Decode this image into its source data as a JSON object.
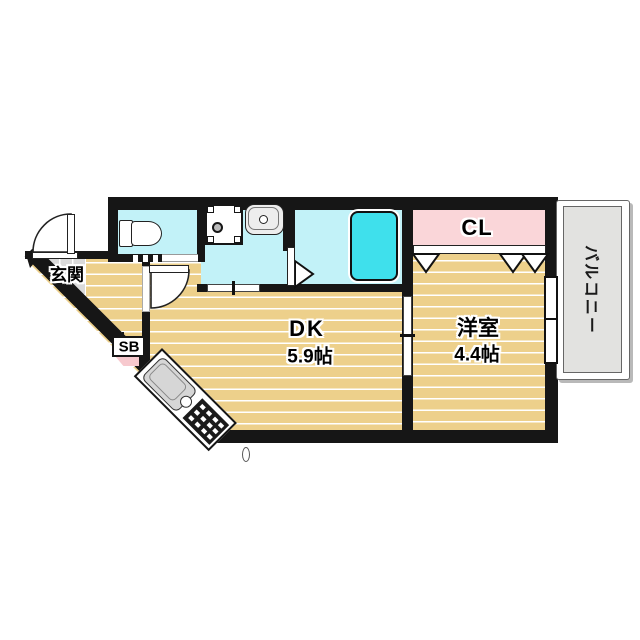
{
  "plan": {
    "rooms": {
      "entrance": {
        "label": "玄関"
      },
      "dining_kitchen": {
        "label": "DK",
        "size": "5.9帖"
      },
      "western_room": {
        "label": "洋室",
        "size": "4.4帖"
      },
      "closet": {
        "label": "CL"
      },
      "balcony": {
        "label": "バルコニー"
      },
      "shoe_box": {
        "label": "SB"
      }
    },
    "fixtures": [
      "toilet",
      "washing-machine-pan",
      "washbasin",
      "bathtub",
      "kitchen-sink",
      "gas-stove",
      "entry-door",
      "hinged-door",
      "sliding-door",
      "folding-door",
      "sliding-window",
      "closet-folding-doors"
    ],
    "colors": {
      "wall": "#161616",
      "wet_area_floor": "#c2f2f8",
      "bathtub": "#3fe0ec",
      "wood_floor": "#edd08b",
      "closet": "#fad6d9",
      "entrance_tile": "#dadada",
      "balcony": "#e2e2e0",
      "shoe_box_accent": "#f7c9ce"
    }
  }
}
